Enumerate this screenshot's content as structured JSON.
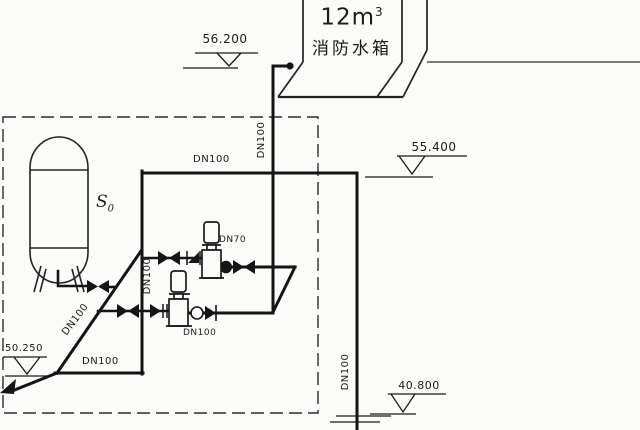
{
  "fire_tank": {
    "volume": "12m",
    "volume_sup": "3",
    "name": "消防水箱"
  },
  "pressure_tank": {
    "label": "S",
    "label_sub": "0"
  },
  "elevations": {
    "roof": "56.200",
    "tank_level": "55.400",
    "pump_room_floor": "50.250",
    "lower_floor": "40.800"
  },
  "pipe_labels": {
    "top_main": "DN100",
    "tank_riser": "DN100",
    "suction_header": "DN100",
    "suction_diagonal": "DN100",
    "bottom_suction": "DN100",
    "pump_top_outlet": "DN70",
    "pump_bottom_outlet": "DN100",
    "drain_riser": "DN100"
  }
}
